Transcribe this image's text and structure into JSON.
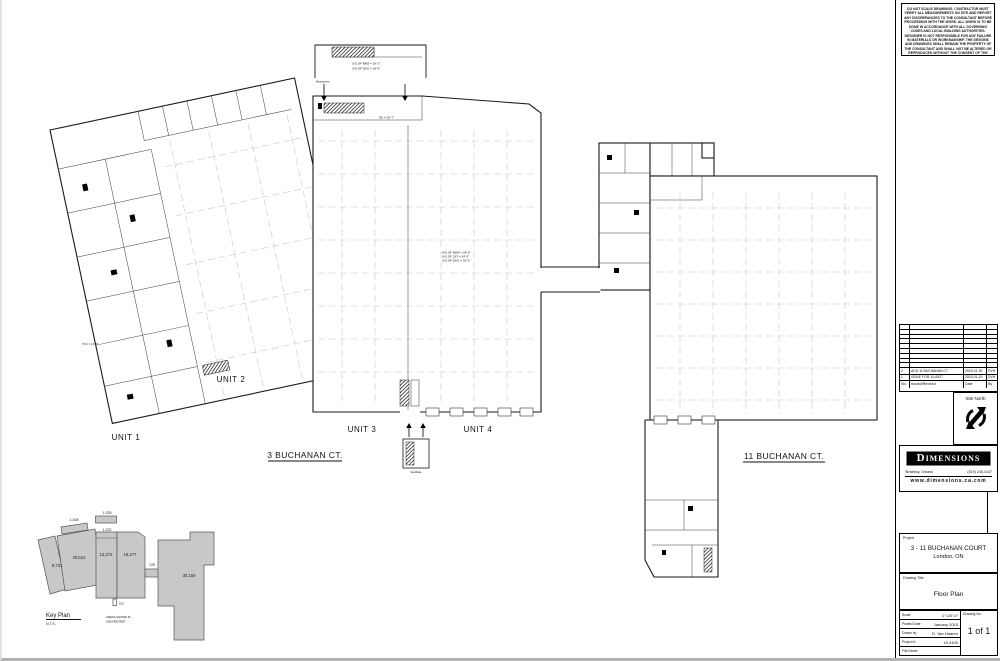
{
  "sheet": {
    "disclaimer": "DO NOT SCALE DRAWINGS. CONTRACTOR MUST VERIFY ALL MEASUREMENTS ON SITE AND REPORT ANY DISCREPANCIES TO THE CONSULTANT BEFORE PROCEEDING WITH THE WORK. ALL WORK IS TO BE DONE IN ACCORDANCE WITH ALL GOVERNING CODES AND LOCAL BUILDING AUTHORITIES. DESIGNER IS NOT RESPONSIBLE FOR ANY FAILURE IN MATERIALS OR WORKMANSHIP. THE DESIGNS AND DRAWINGS SHALL REMAIN THE PROPERTY OF THE CONSULTANT AND SHALL NOT BE ALTERED OR REPRODUCED WITHOUT THE CONSENT OF THE CONSULTANT.",
    "colors": {
      "wall": "#1a1a1a",
      "grid": "#c6c6c6",
      "keyplan_fill": "#c8c8c8"
    }
  },
  "plan": {
    "unit1": "UNIT 1",
    "unit2": "UNIT 2",
    "unit3": "UNIT 3",
    "unit4": "UNIT 4",
    "address_3": "3 BUCHANAN CT.",
    "address_11": "11 BUCHANAN CT.",
    "mezzanine_label": "Mezzanine",
    "vestibule_label": "Vestibule",
    "notes": {
      "mezz_1": "U/S OF BMS = 19'-2\"",
      "mezz_2": "U/S OF DKG = 18'-0\"",
      "deck": "DK = 19'-7\"",
      "center_1": "U/S OF BDM = 28'-6\"",
      "center_2": "U/S OF JST = 24'-3\"",
      "center_3": "U/S OF DKG = 25'-0\"",
      "joist": "TOJ = 16'-7\""
    }
  },
  "keyplan": {
    "title": "Key Plan",
    "scale": "N.T.S.",
    "areas_note_1": "AREAS SHOWN IN",
    "areas_note_2": "SQUARE FEET",
    "scale_figure": "150",
    "areas": {
      "office_wing": "8,731",
      "unit2": "20,624",
      "unit3": "13,372",
      "unit4": "19,477",
      "link": "725",
      "building11": "30,159",
      "mezz_a": "1,408",
      "mezz_b": "1,035",
      "mezz_c": "1,022"
    }
  },
  "titleblock": {
    "revisions": {
      "header": {
        "no": "No.",
        "issued": "Issued/Revised",
        "date": "Date",
        "by": "By"
      },
      "rows": [
        {
          "no": "2",
          "desc": "ADD 11 BUCHANAN CT",
          "date": "2015-01-30",
          "by": "DVH"
        },
        {
          "no": "1",
          "desc": "ISSUE FOR 14-A527",
          "date": "2015-01-19",
          "by": "DVH"
        }
      ]
    },
    "site_north": "Site North",
    "logo": {
      "name": "Dimensions",
      "city": "Strathroy, Ontario",
      "phone": "(519) 245-4147",
      "web": "www.dimensions.ca.com"
    },
    "project_label": "Project",
    "project_name": "3 - 11 BUCHANAN COURT",
    "project_city": "London, ON",
    "drawing_title_label": "Drawing Title",
    "drawing_title": "Floor Plan",
    "info": {
      "scale_label": "Scale",
      "scale": "1\"=20'-0\"",
      "plotted_label": "Plotted Date",
      "plotted": "January 2015",
      "drawn_label": "Drawn by",
      "drawn": "D. Van Haaren",
      "project_no_label": "Project #",
      "project_no": "15-4100",
      "file_label": "File Name",
      "file": "",
      "drawing_no_label": "Drawing No.",
      "drawing_no": "1 of 1"
    }
  }
}
